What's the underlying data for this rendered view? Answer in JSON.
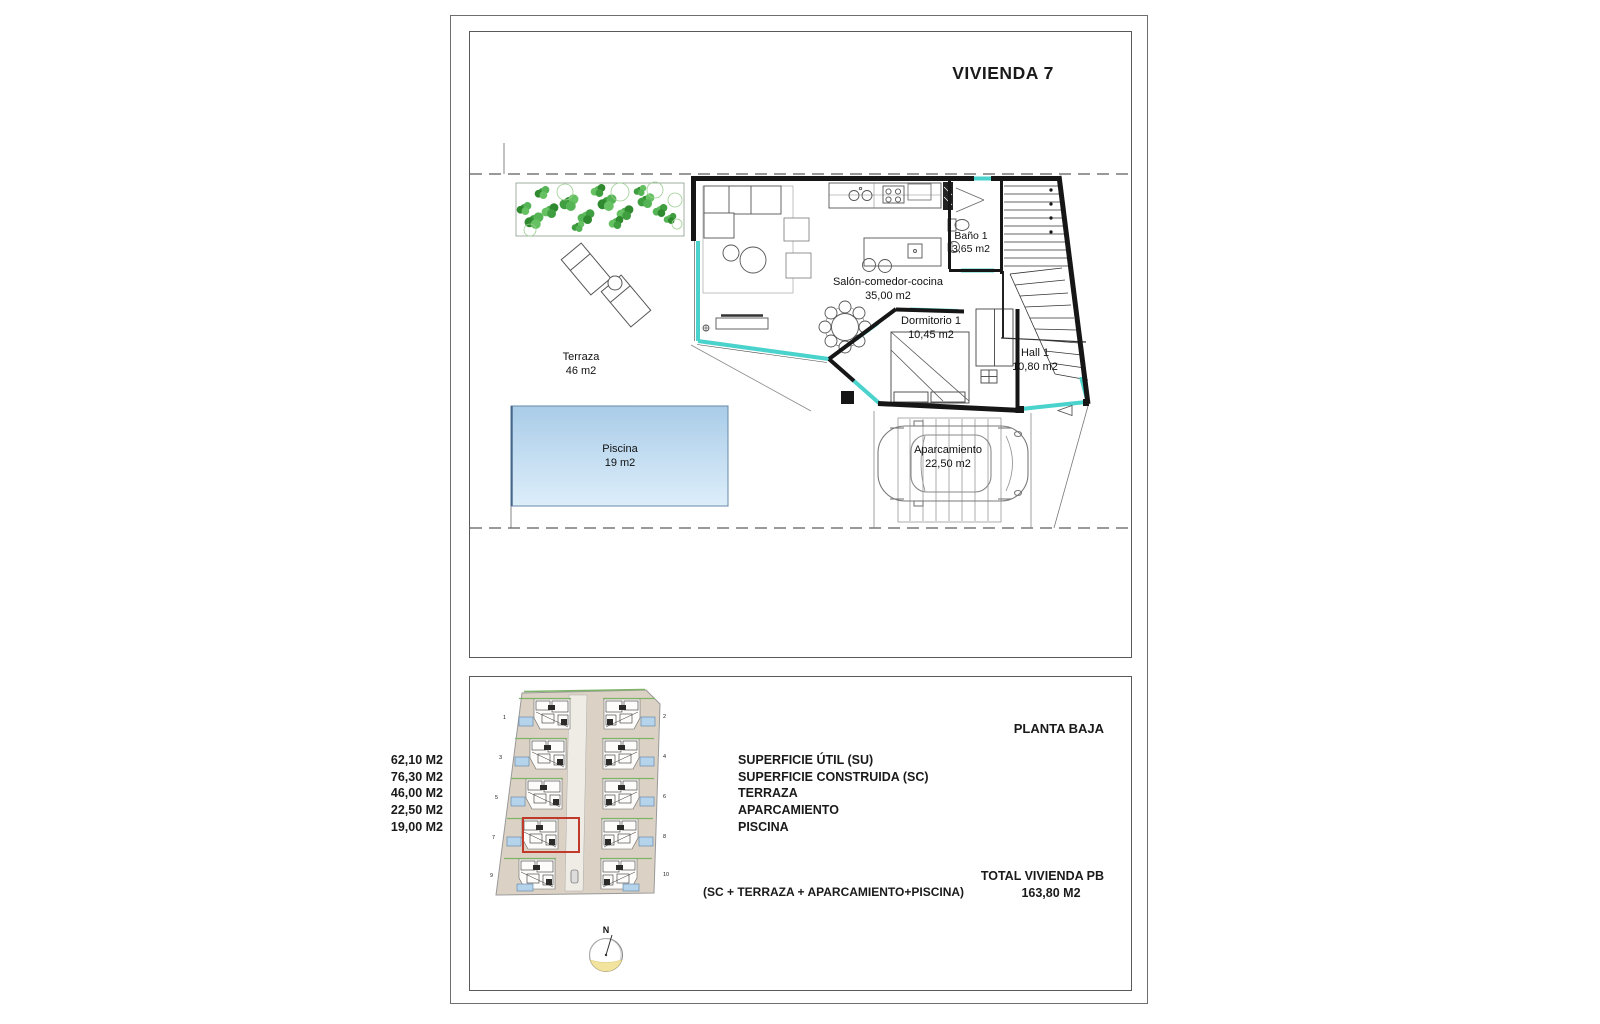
{
  "sheet": {
    "title": "VIVIENDA 7"
  },
  "floor_plan": {
    "rooms": {
      "terraza": {
        "name": "Terraza",
        "area": "46 m2"
      },
      "piscina": {
        "name": "Piscina",
        "area": "19 m2"
      },
      "salon": {
        "name": "Salón-comedor-cocina",
        "area": "35,00 m2"
      },
      "bano": {
        "name": "Baño 1",
        "area": "3,65 m2"
      },
      "dormitorio": {
        "name": "Dormitorio 1",
        "area": "10,45 m2"
      },
      "hall": {
        "name": "Hall 1",
        "area": "10,80 m2"
      },
      "aparcamiento": {
        "name": "Aparcamiento",
        "area": "22,50 m2"
      }
    }
  },
  "summary": {
    "header": "PLANTA BAJA",
    "rows": [
      {
        "label": "SUPERFICIE ÚTIL (SU)",
        "value": "62,10 M2"
      },
      {
        "label": "SUPERFICIE CONSTRUIDA (SC)",
        "value": "76,30 M2"
      },
      {
        "label": "TERRAZA",
        "value": "46,00 M2"
      },
      {
        "label": "APARCAMIENTO",
        "value": "22,50 M2"
      },
      {
        "label": "PISCINA",
        "value": "19,00 M2"
      }
    ],
    "total_label": "TOTAL VIVIENDA PB",
    "total_value": "163,80 M2",
    "formula": "(SC + TERRAZA + APARCAMIENTO+PISCINA)"
  },
  "site_plan": {
    "compass": "N",
    "highlighted_unit": "7",
    "markers": [
      "1",
      "2",
      "3",
      "4",
      "5",
      "6",
      "7",
      "8",
      "9",
      "10"
    ]
  },
  "colors": {
    "glass": "#4ad2cc",
    "wall": "#161616",
    "pool_top": "#a9cce8",
    "pool_bottom": "#ddeefa",
    "highlight_red": "#c0392b",
    "site_bg": "#dbd2c5",
    "plant_green": "#459e45",
    "compass_yellow": "#f2e49e"
  }
}
